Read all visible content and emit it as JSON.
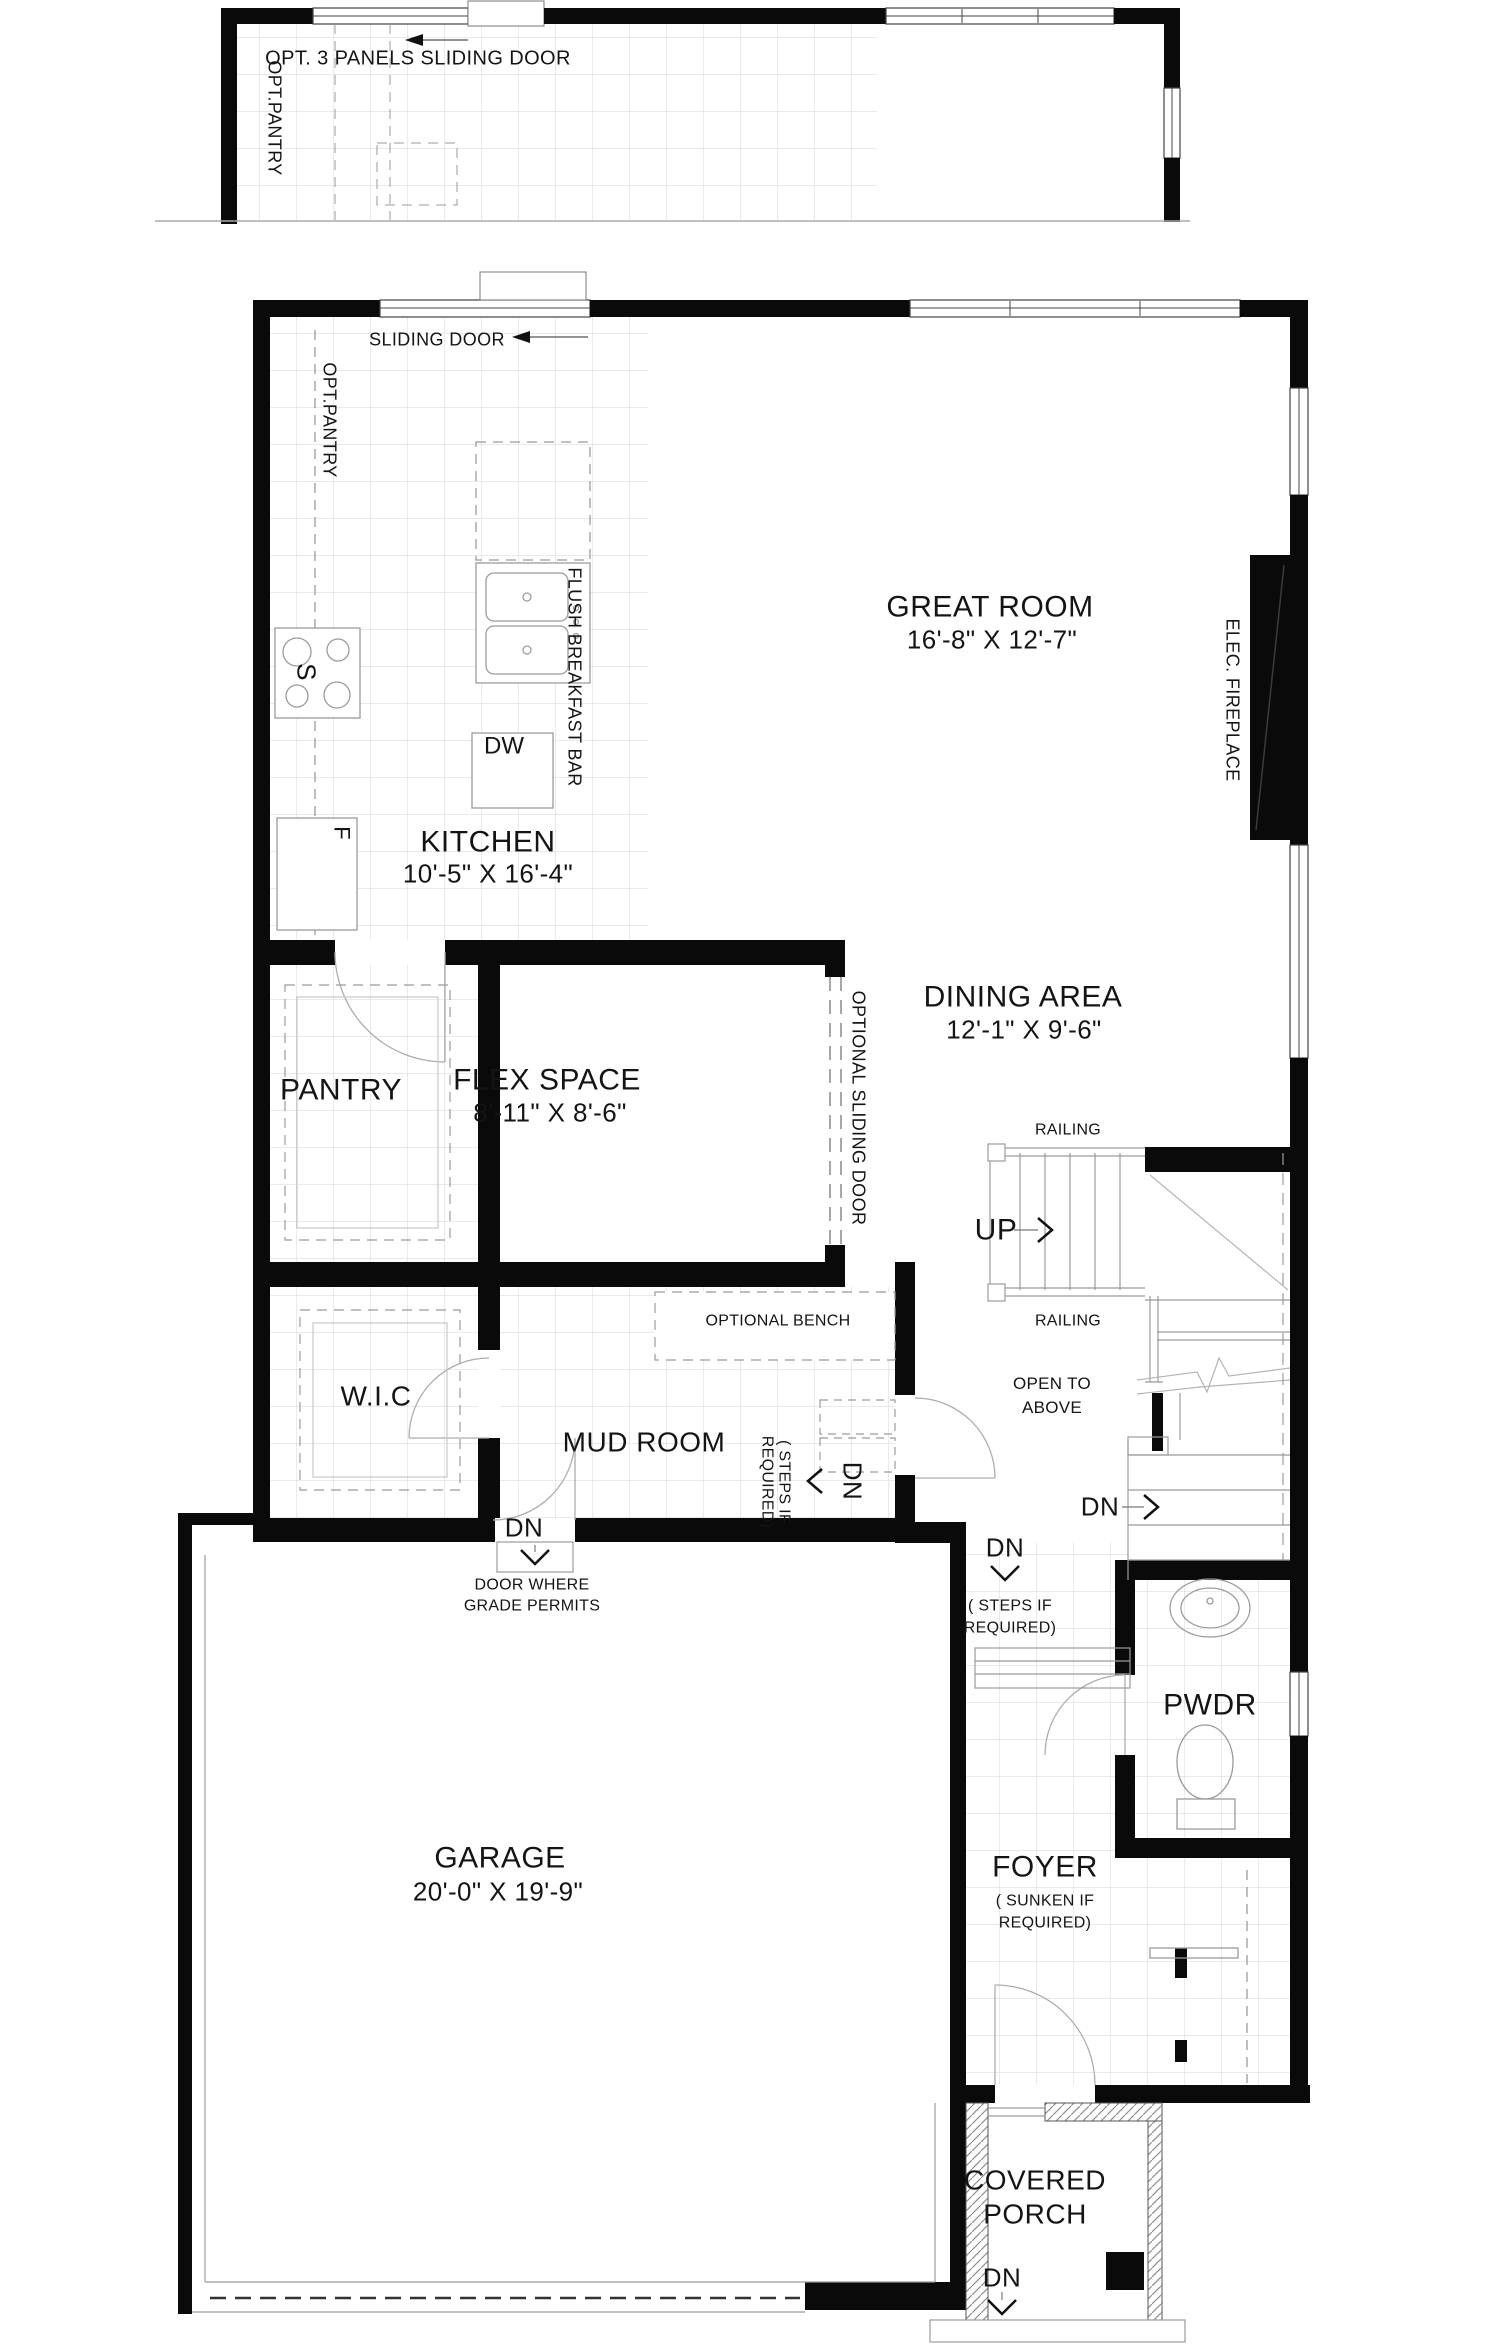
{
  "document": {
    "type": "architectural floor plan",
    "floor": "main floor"
  },
  "colors": {
    "wall": "#0a0a0a",
    "line": "#9b9b9b",
    "tile": "#d4d4d4",
    "text": "#141414",
    "background": "#ffffff"
  },
  "optional_layout_inset": {
    "door_label": "OPT. 3 PANELS SLIDING DOOR",
    "pantry_label": "OPT.PANTRY"
  },
  "rooms": {
    "kitchen": {
      "name": "KITCHEN",
      "dims": "10'-5\" X 16'-4\""
    },
    "great_room": {
      "name": "GREAT ROOM",
      "dims": "16'-8\" X 12'-7\""
    },
    "dining_area": {
      "name": "DINING AREA",
      "dims": "12'-1\" X 9'-6\""
    },
    "flex_space": {
      "name": "FLEX SPACE",
      "dims": "8'-11\" X 8'-6\""
    },
    "pantry": {
      "name": "PANTRY"
    },
    "wic": {
      "name": "W.I.C"
    },
    "mud_room": {
      "name": "MUD ROOM"
    },
    "pwdr": {
      "name": "PWDR"
    },
    "foyer": {
      "name": "FOYER",
      "note1": "( SUNKEN IF",
      "note2": "REQUIRED)"
    },
    "garage": {
      "name": "GARAGE",
      "dims": "20'-0\" X 19'-9\""
    },
    "covered_porch": {
      "name1": "COVERED",
      "name2": "PORCH"
    }
  },
  "annotations": {
    "sliding_door": "SLIDING DOOR",
    "opt_pantry": "OPT.PANTRY",
    "flush_breakfast_bar": "FLUSH BREAKFAST BAR",
    "stove": "S",
    "dishwasher": "DW",
    "fridge": "F",
    "elec_fireplace": "ELEC. FIREPLACE",
    "optional_sliding_door": "OPTIONAL SLIDING DOOR",
    "railing": "RAILING",
    "open_to_above1": "OPEN TO",
    "open_to_above2": "ABOVE",
    "optional_bench": "OPTIONAL BENCH",
    "steps_if1": "( STEPS IF",
    "steps_if2": "REQUIRED)",
    "door_where1": "DOOR WHERE",
    "door_where2": "GRADE PERMITS",
    "up": "UP",
    "down": "DN"
  }
}
